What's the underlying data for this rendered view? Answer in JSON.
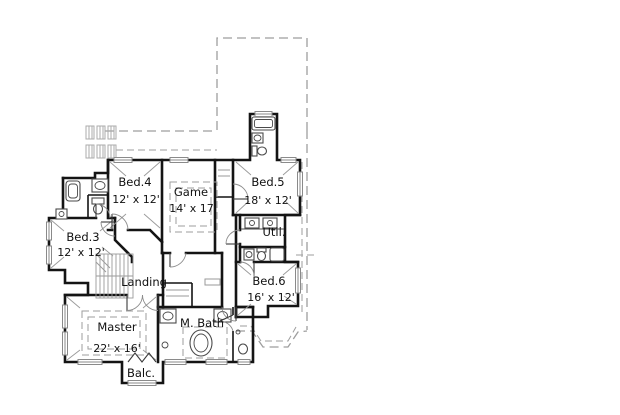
{
  "plan": {
    "type": "floor-plan",
    "rooms": {
      "bed4": {
        "name": "Bed.4",
        "size": "12' x 12'"
      },
      "game": {
        "name": "Game",
        "size": "14' x 17'"
      },
      "bed5": {
        "name": "Bed.5",
        "size": "18' x 12'"
      },
      "bed3": {
        "name": "Bed.3",
        "size": "12' x 12'"
      },
      "util": {
        "name": "Util."
      },
      "bed6": {
        "name": "Bed.6",
        "size": "16' x 12'"
      },
      "landing": {
        "name": "Landing"
      },
      "master": {
        "name": "Master",
        "size": "22' x 16'"
      },
      "mbath": {
        "name": "M. Bath"
      },
      "balcony": {
        "name": "Balc."
      }
    },
    "colors": {
      "wall": "#141414",
      "fixture": "#4a4a4a",
      "line": "#9a9a9a",
      "dash": "#9e9e9e",
      "hatch": "#ababab",
      "text": "#111111",
      "background": "#ffffff"
    }
  }
}
